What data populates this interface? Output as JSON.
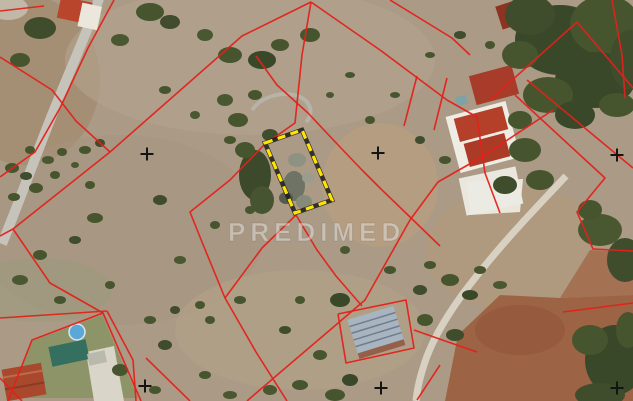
{
  "map": {
    "watermark": "PREDIMED",
    "colors": {
      "boundary_red": "#e4211a",
      "highlight_yellow": "#ffe400",
      "highlight_underlay": "#1c1c1c",
      "cross_black": "#141414"
    },
    "survey_crosses": [
      [
        147,
        154
      ],
      [
        378,
        153
      ],
      [
        617,
        155
      ],
      [
        145,
        386
      ],
      [
        381,
        388
      ],
      [
        617,
        388
      ]
    ],
    "highlight_parcel": {
      "points": [
        [
          265,
          143
        ],
        [
          302,
          130
        ],
        [
          332,
          200
        ],
        [
          295,
          213
        ]
      ]
    },
    "boundaries": [
      [
        [
          0,
          11
        ],
        [
          44,
          6
        ]
      ],
      [
        [
          114,
          0
        ],
        [
          88,
          48
        ],
        [
          60,
          108
        ],
        [
          35,
          152
        ],
        [
          0,
          177
        ]
      ],
      [
        [
          0,
          57
        ],
        [
          52,
          90
        ],
        [
          76,
          121
        ],
        [
          110,
          152
        ]
      ],
      [
        [
          311,
          2
        ],
        [
          242,
          36
        ],
        [
          110,
          152
        ]
      ],
      [
        [
          110,
          152
        ],
        [
          13,
          229
        ],
        [
          0,
          236
        ]
      ],
      [
        [
          13,
          229
        ],
        [
          50,
          283
        ],
        [
          103,
          313
        ]
      ],
      [
        [
          0,
          318
        ],
        [
          107,
          311
        ]
      ],
      [
        [
          8,
          401
        ],
        [
          32,
          340
        ],
        [
          103,
          313
        ],
        [
          141,
          401
        ]
      ],
      [
        [
          0,
          378
        ],
        [
          22,
          401
        ]
      ],
      [
        [
          107,
          311
        ],
        [
          133,
          360
        ],
        [
          136,
          401
        ]
      ],
      [
        [
          146,
          358
        ],
        [
          190,
          401
        ]
      ],
      [
        [
          311,
          2
        ],
        [
          302,
          55
        ],
        [
          295,
          123
        ],
        [
          265,
          144
        ],
        [
          230,
          180
        ],
        [
          190,
          212
        ],
        [
          202,
          242
        ],
        [
          225,
          298
        ],
        [
          256,
          352
        ],
        [
          287,
          401
        ]
      ],
      [
        [
          296,
          215
        ],
        [
          262,
          248
        ],
        [
          225,
          298
        ]
      ],
      [
        [
          296,
          215
        ],
        [
          317,
          250
        ],
        [
          336,
          276
        ],
        [
          362,
          306
        ]
      ],
      [
        [
          256,
          56
        ],
        [
          277,
          85
        ],
        [
          308,
          113
        ],
        [
          340,
          147
        ],
        [
          362,
          170
        ],
        [
          380,
          188
        ],
        [
          440,
          246
        ]
      ],
      [
        [
          311,
          2
        ],
        [
          380,
          50
        ],
        [
          447,
          100
        ]
      ],
      [
        [
          390,
          0
        ],
        [
          452,
          38
        ],
        [
          470,
          55
        ]
      ],
      [
        [
          447,
          100
        ],
        [
          477,
          117
        ],
        [
          485,
          173
        ],
        [
          500,
          213
        ]
      ],
      [
        [
          417,
          76
        ],
        [
          404,
          126
        ]
      ],
      [
        [
          447,
          78
        ],
        [
          434,
          130
        ]
      ],
      [
        [
          577,
          22
        ],
        [
          490,
          100
        ]
      ],
      [
        [
          577,
          22
        ],
        [
          633,
          88
        ]
      ],
      [
        [
          612,
          0
        ],
        [
          622,
          55
        ],
        [
          625,
          98
        ]
      ],
      [
        [
          527,
          80
        ],
        [
          633,
          168
        ]
      ],
      [
        [
          515,
          95
        ],
        [
          605,
          178
        ],
        [
          577,
          212
        ],
        [
          593,
          249
        ],
        [
          633,
          251
        ]
      ],
      [
        [
          553,
          110
        ],
        [
          480,
          158
        ],
        [
          438,
          182
        ],
        [
          410,
          220
        ],
        [
          365,
          300
        ],
        [
          330,
          330
        ],
        [
          283,
          370
        ],
        [
          247,
          401
        ]
      ],
      [
        [
          338,
          314
        ],
        [
          406,
          300
        ],
        [
          414,
          348
        ],
        [
          346,
          363
        ],
        [
          338,
          314
        ]
      ],
      [
        [
          414,
          330
        ],
        [
          448,
          342
        ],
        [
          477,
          352
        ]
      ],
      [
        [
          440,
          365
        ],
        [
          417,
          400
        ]
      ],
      [
        [
          563,
          312
        ],
        [
          633,
          303
        ]
      ]
    ]
  }
}
